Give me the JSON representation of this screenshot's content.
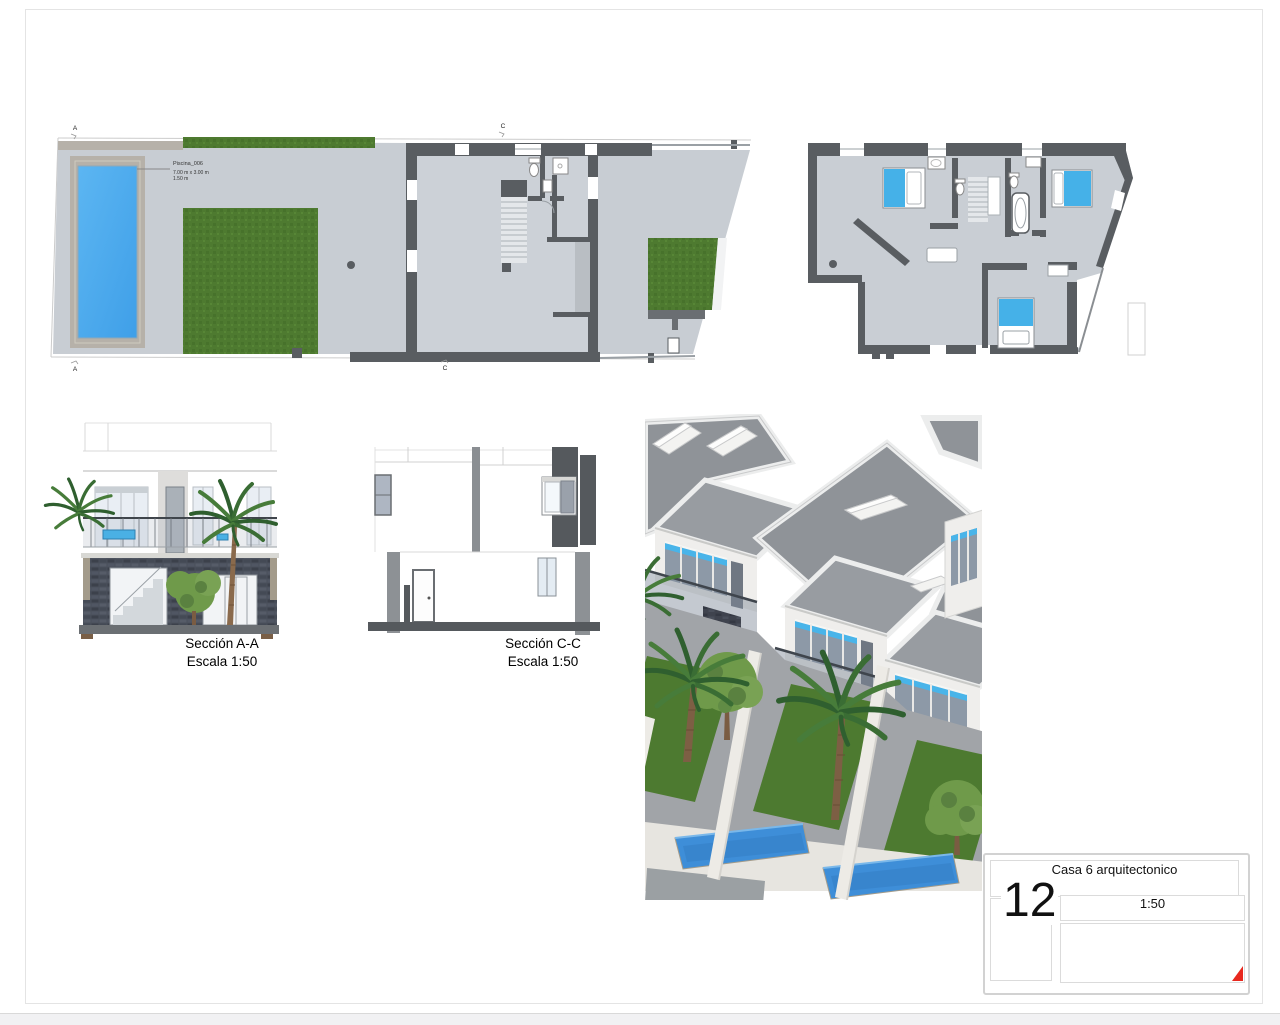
{
  "sheet": {
    "title": "Casa 6 arquitectonico",
    "number": "12",
    "scale": "1:50"
  },
  "ground_plan": {
    "markers": {
      "top_a": "A",
      "top_c": "C",
      "bottom_a": "A",
      "bottom_c": "C"
    },
    "pool": {
      "name": "Piscina_006",
      "size": "7.00 m x 3.00 m",
      "depth": "1.50 m"
    }
  },
  "sections": {
    "aa": {
      "title": "Sección A-A",
      "scale": "Escala 1:50"
    },
    "cc": {
      "title": "Sección C-C",
      "scale": "Escala 1:50"
    }
  },
  "colors": {
    "wall": "#595d61",
    "floor": "#c9ced4",
    "lawn": "#4e7a30",
    "pool_water": "#45aaef",
    "pool_deck": "#b6b1a9",
    "bed": "#45b1e8",
    "roof": "#8f9398",
    "stone": "#4a505b",
    "accent_red": "#e8281e"
  }
}
